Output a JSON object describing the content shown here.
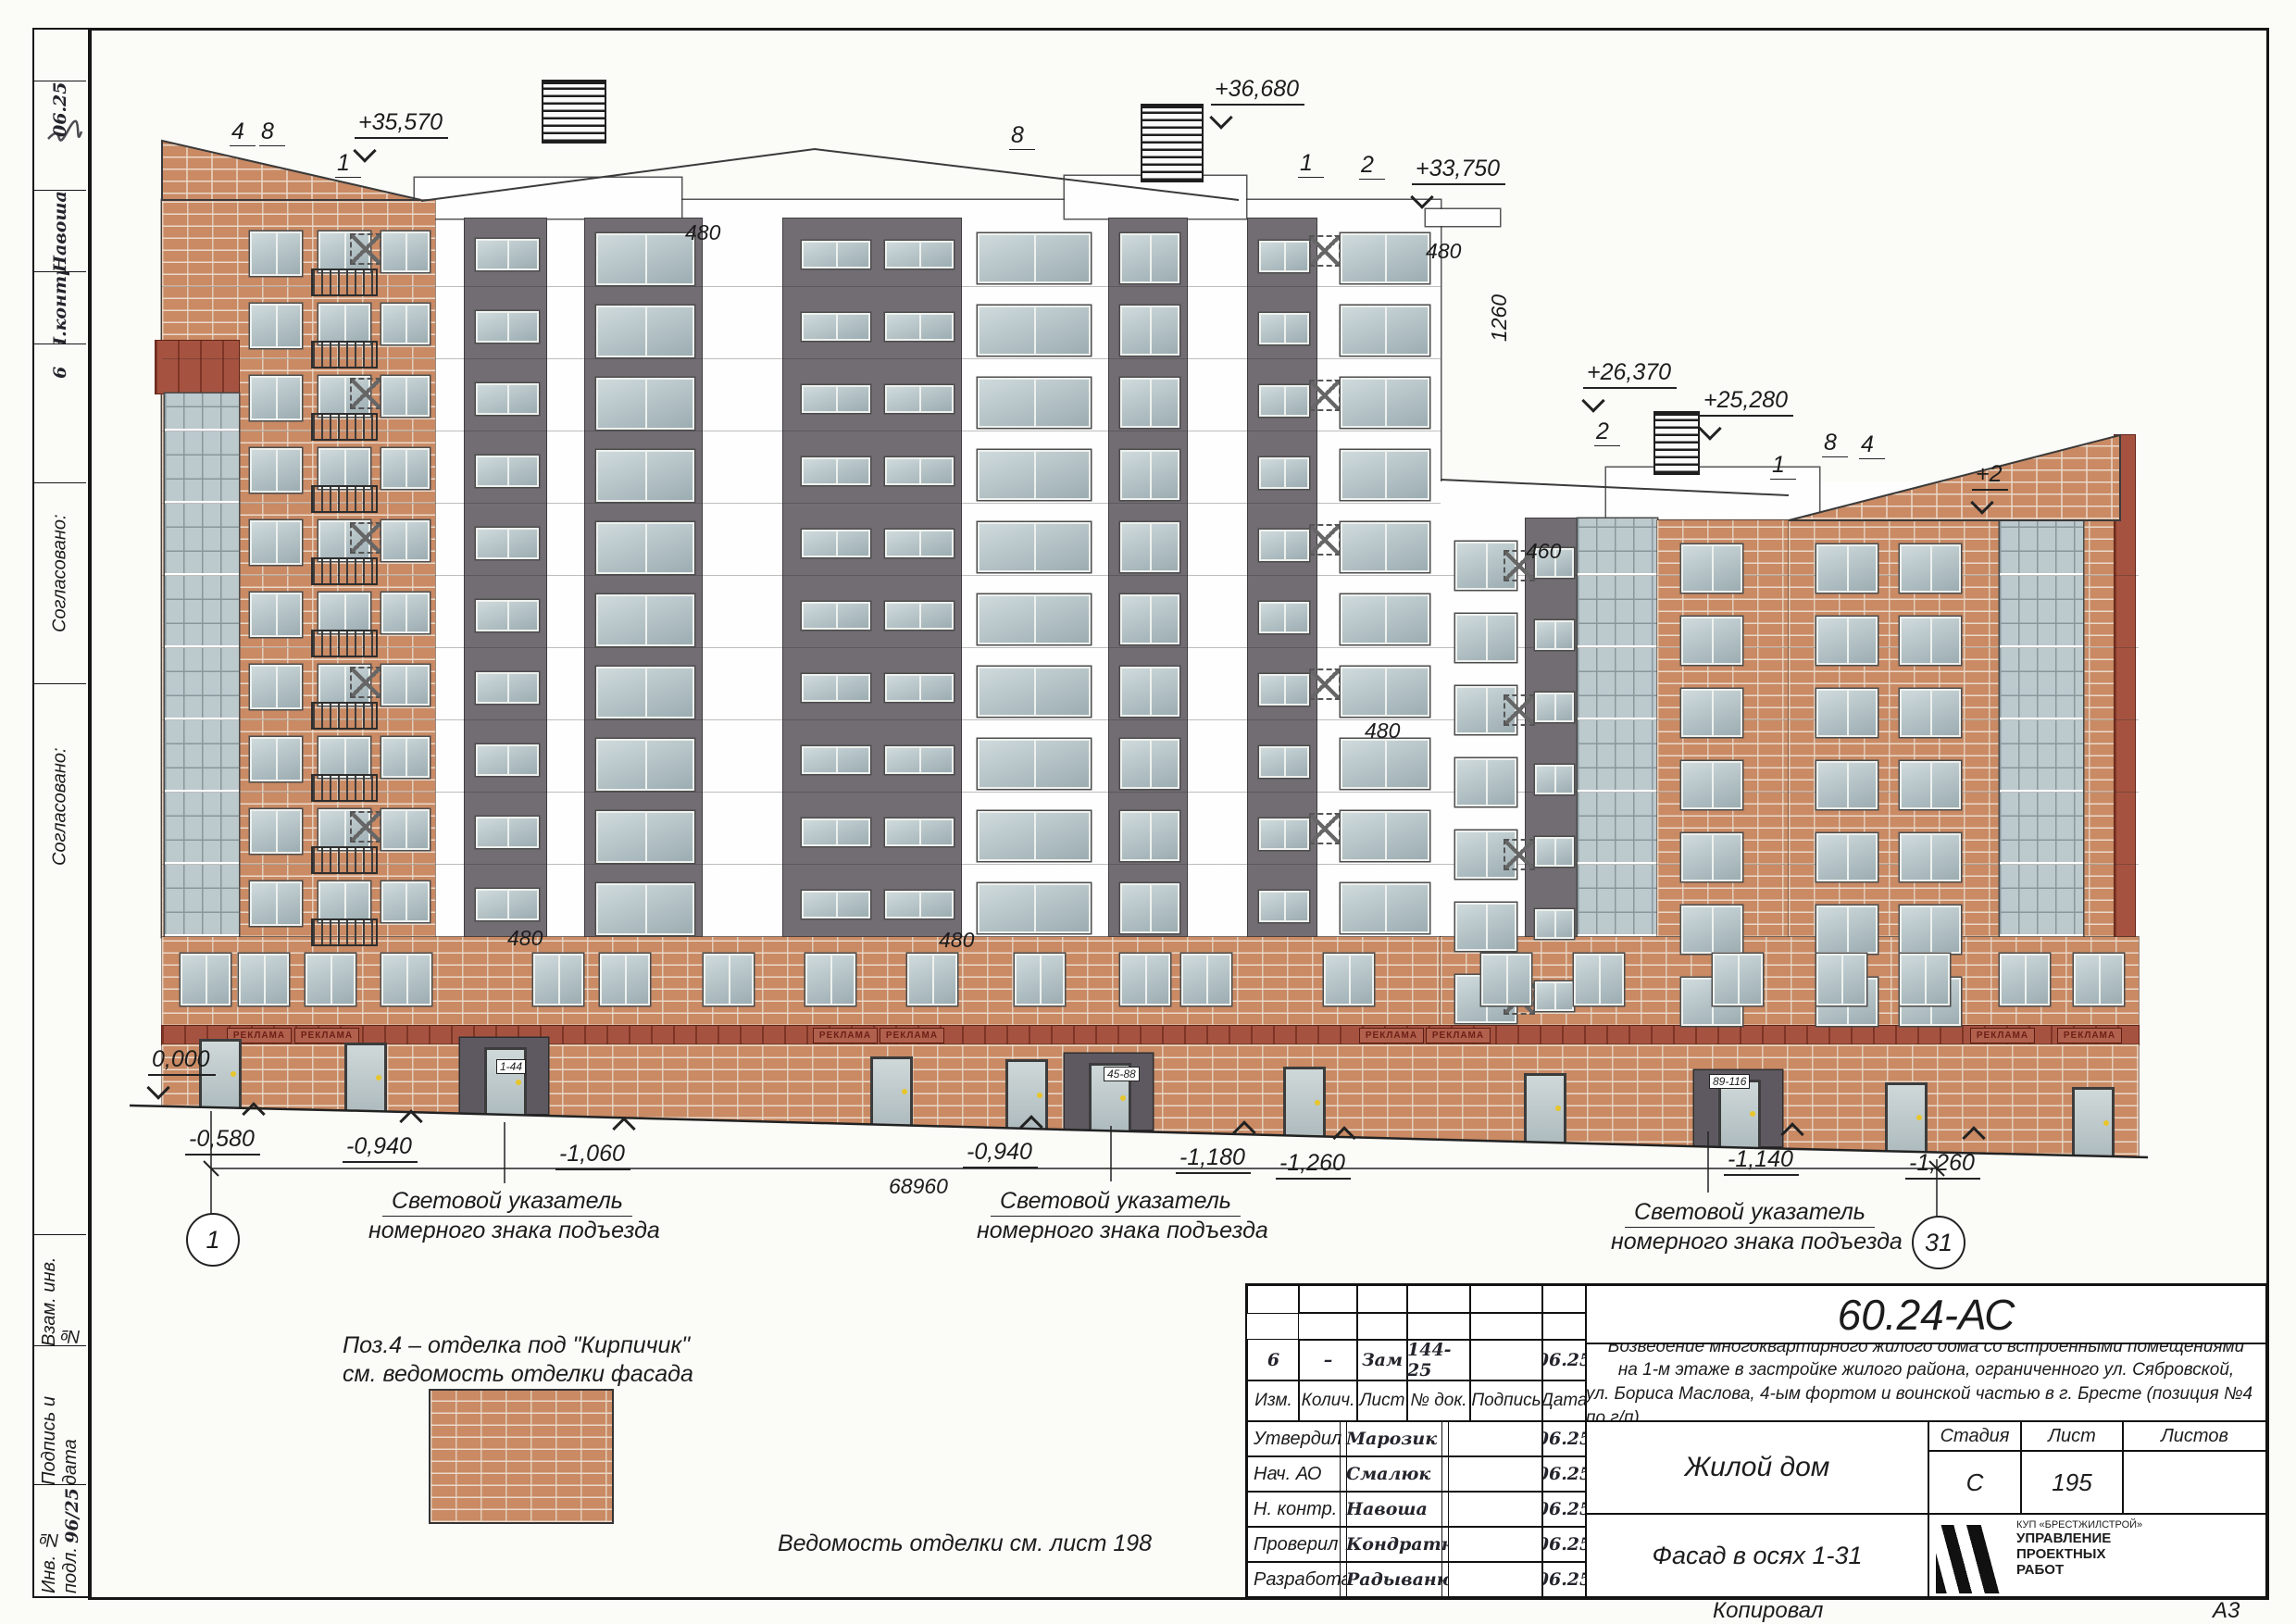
{
  "sheet": {
    "copied_label": "Копировал",
    "format_label": "А3",
    "finish_note_line1": "Поз.4 – отделка под \"Кирпичик\"",
    "finish_note_line2": "см. ведомость отделки фасада",
    "finish_ref": "Ведомость отделки см. лист 198"
  },
  "margin": {
    "date_top": "06.25",
    "name1": "Навоша",
    "name2": "Н.контр",
    "num": "6",
    "agreed": "Согласовано:",
    "vzam": "Взам. инв. №",
    "podpis": "Подпись и дата",
    "inv": "Инв. № подл.",
    "inv_no": "96/25"
  },
  "title_block": {
    "doc_code": "60.24-АС",
    "description_1": "Возведение многоквартирного жилого дома со встроенными помещениями",
    "description_2": "на 1-м этаже в застройке жилого района, ограниченного ул. Сябровской,",
    "description_3": "ул. Бориса Маслова, 4-ым фортом и воинской частью в г. Бресте (позиция №4 по г/п)",
    "change_row": {
      "izm": "6",
      "kolich": "–",
      "list": "Зам",
      "doc": "144-25",
      "date": "06.25"
    },
    "change_headers": [
      "Изм.",
      "Колич.",
      "Лист",
      "№ док.",
      "Подпись",
      "Дата"
    ],
    "roles": [
      {
        "role": "Утвердил",
        "name": "Марозик",
        "date": "06.25"
      },
      {
        "role": "Нач. АО",
        "name": "Смалюк",
        "date": "06.25"
      },
      {
        "role": "Н. контр.",
        "name": "Навоша",
        "date": "06.25"
      },
      {
        "role": "Проверил",
        "name": "Кондратюк",
        "date": "06.25"
      },
      {
        "role": "Разработал",
        "name": "Радыванюк",
        "date": "06.25"
      }
    ],
    "object_name": "Жилой дом",
    "drawing_name": "Фасад в осях 1-31",
    "stage_label": "Стадия",
    "sheet_label": "Лист",
    "sheets_label": "Листов",
    "stage": "С",
    "sheet_no": "195",
    "sheets": "",
    "company_top": "КУП «БРЕСТЖИЛСТРОЙ»",
    "company_1": "УПРАВЛЕНИЕ",
    "company_2": "ПРОЕКТНЫХ",
    "company_3": "РАБОТ"
  },
  "annotations": {
    "elevations": [
      "+35,570",
      "+36,680",
      "+33,750",
      "+26,370",
      "+25,280",
      "+2",
      "0,000",
      "-0,580",
      "-0,940",
      "-1,060",
      "-0,940",
      "-1,180",
      "-1,260",
      "-1,140",
      "-1,260"
    ],
    "axis_leaders": [
      "4",
      "8",
      "1",
      "8",
      "1",
      "2",
      "2",
      "8",
      "4",
      "1"
    ],
    "axis_bubbles": [
      "1",
      "31"
    ],
    "dims": [
      "480",
      "480",
      "1260",
      "460",
      "480",
      "480",
      "480",
      "68960"
    ],
    "entrance_plates": [
      "1-44",
      "45-88",
      "89-116"
    ],
    "entrance_note_1": "Световой указатель",
    "entrance_note_2": "номерного знака подъезда",
    "sign": "РЕКЛАМА"
  }
}
